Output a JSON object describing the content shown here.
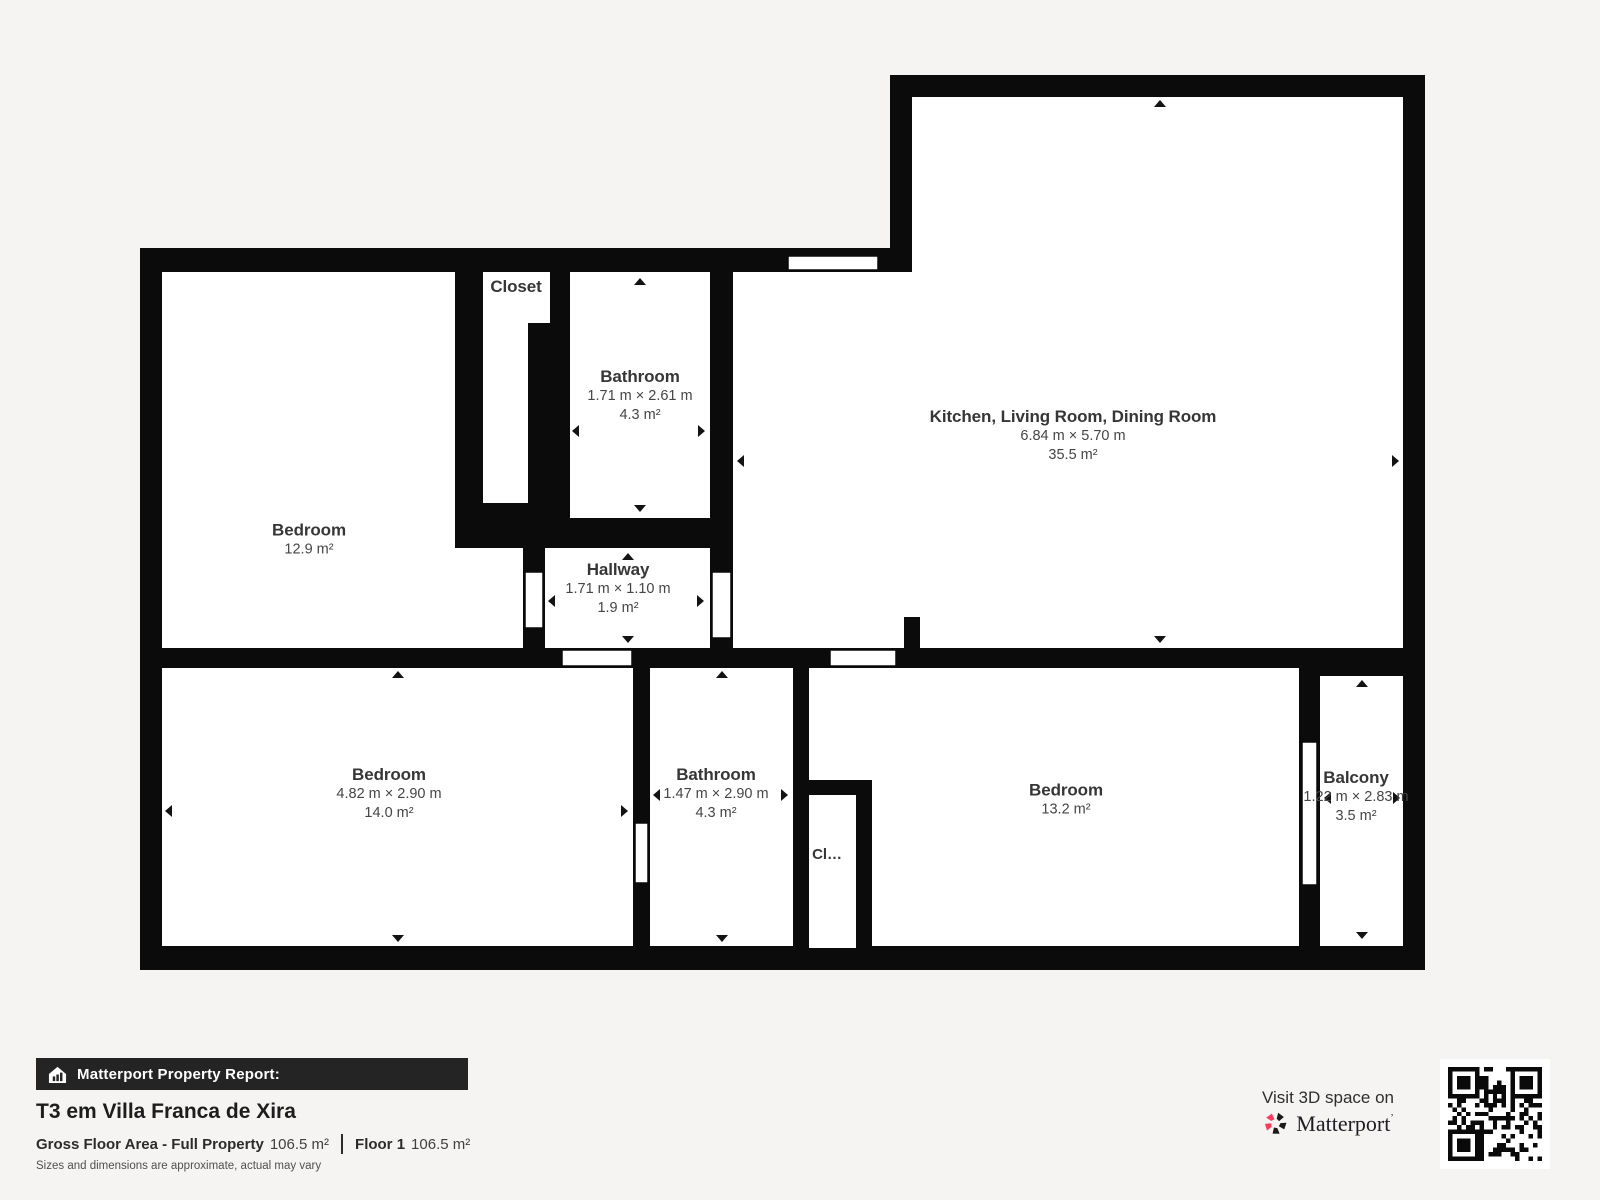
{
  "plan": {
    "rooms": {
      "bedroom_tl": {
        "title": "Bedroom",
        "area": "12.9 m²"
      },
      "closet_t": {
        "title": "Closet"
      },
      "bathroom_t": {
        "title": "Bathroom",
        "dims": "1.71 m × 2.61 m",
        "area": "4.3 m²"
      },
      "hallway": {
        "title": "Hallway",
        "dims": "1.71 m × 1.10 m",
        "area": "1.9 m²"
      },
      "kitchen_living_dining": {
        "title": "Kitchen, Living Room, Dining Room",
        "dims": "6.84 m × 5.70 m",
        "area": "35.5 m²"
      },
      "bedroom_bl": {
        "title": "Bedroom",
        "dims": "4.82 m × 2.90 m",
        "area": "14.0 m²"
      },
      "bathroom_b": {
        "title": "Bathroom",
        "dims": "1.47 m × 2.90 m",
        "area": "4.3 m²"
      },
      "closet_b": {
        "title": "Cl…"
      },
      "bedroom_br": {
        "title": "Bedroom",
        "area": "13.2 m²"
      },
      "balcony": {
        "title": "Balcony",
        "dims": "1.22 m × 2.83 m",
        "area": "3.5 m²"
      }
    }
  },
  "footer": {
    "report_label": "Matterport Property Report:",
    "property_name": "T3 em Villa Franca de Xira",
    "gross_label": "Gross Floor Area - Full Property",
    "gross_value": "106.5 m²",
    "floor_label": "Floor 1",
    "floor_value": "106.5 m²",
    "disclaimer": "Sizes and dimensions are approximate, actual may vary",
    "visit_text": "Visit 3D space on",
    "brand": "Matterport",
    "brand_mark": "’"
  },
  "colors": {
    "background": "#f5f4f2",
    "wall": "#0b0b0b",
    "floor": "#ffffff",
    "accent_pink": "#fb3b5c",
    "label_text": "#363636"
  }
}
